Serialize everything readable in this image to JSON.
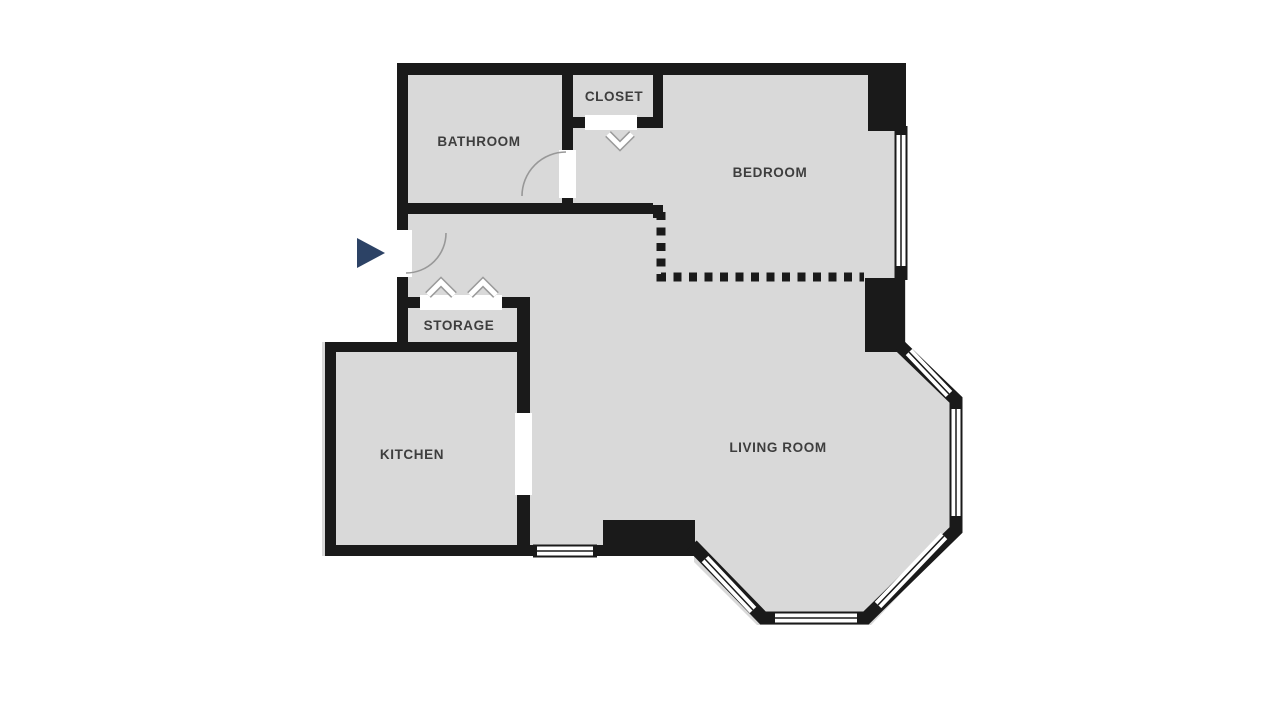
{
  "floorplan": {
    "type": "apartment-floor-plan",
    "rooms": [
      {
        "id": "bathroom",
        "label": "BATHROOM"
      },
      {
        "id": "closet",
        "label": "CLOSET"
      },
      {
        "id": "bedroom",
        "label": "BEDROOM"
      },
      {
        "id": "storage",
        "label": "STORAGE"
      },
      {
        "id": "kitchen",
        "label": "KITCHEN"
      },
      {
        "id": "living_room",
        "label": "LIVING ROOM"
      }
    ],
    "colors": {
      "canvas_background": "#ffffff",
      "floor_fill": "#d9d9d9",
      "wall": "#1a1a1a",
      "window_fill": "#ffffff",
      "door_arc": "#989898",
      "chevron_outline": "#9a9a9a",
      "room_label": "#3e3e3e",
      "entrance_marker": "#2c4265"
    },
    "icons": {
      "entrance_marker": "triangle-right-icon",
      "door_swing": "quarter-arc",
      "folding_door": "chevron-up-icon",
      "closet_door": "chevron-down-icon"
    },
    "features": {
      "dashed_partition": "bedroom open boundary",
      "bay_windows": "living room octagonal bay",
      "windows": "bedroom east, kitchen south, living room bay"
    }
  }
}
